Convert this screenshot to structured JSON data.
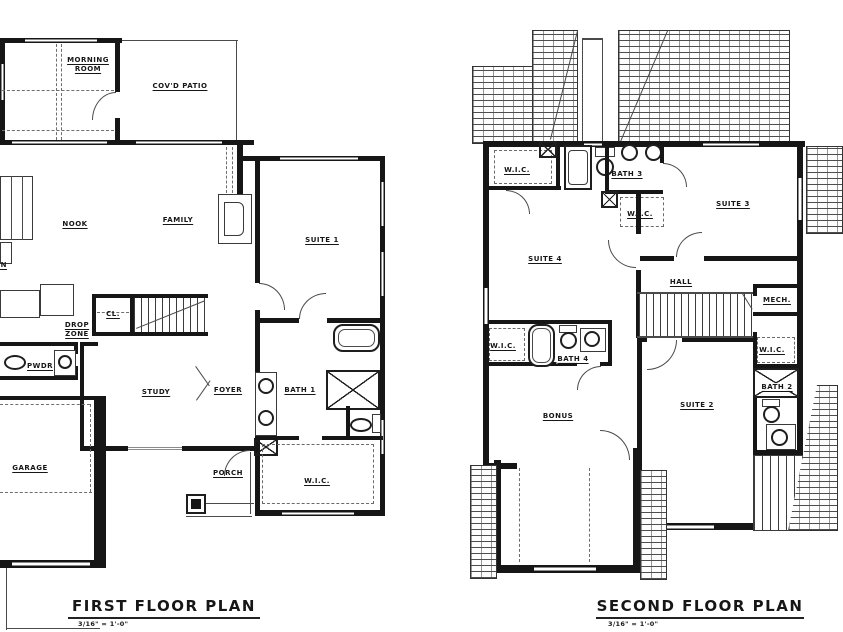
{
  "page": {
    "background": "#ffffff",
    "ink": "#1a1a1a"
  },
  "first_floor": {
    "title": "FIRST FLOOR PLAN",
    "scale": "3/16\" = 1'-0\"",
    "rooms": {
      "morning_room": "MORNING\nROOM",
      "covd_patio": "COV'D PATIO",
      "nook": "NOOK",
      "family": "FAMILY",
      "kitchen": "KITCHEN",
      "suite1": "SUITE 1",
      "drop_zone": "DROP\nZONE",
      "closet": "CL.",
      "pwdr": "PWDR",
      "study": "STUDY",
      "foyer": "FOYER",
      "bath1": "BATH 1",
      "garage": "GARAGE",
      "porch": "PORCH",
      "wic": "W.I.C."
    }
  },
  "second_floor": {
    "title": "SECOND FLOOR PLAN",
    "scale": "3/16\" = 1'-0\"",
    "rooms": {
      "wic_top_left": "W.I.C.",
      "bath3": "BATH 3",
      "wic_mid": "W.I.C.",
      "suite3": "SUITE 3",
      "suite4": "SUITE 4",
      "hall": "HALL",
      "mech": "MECH.",
      "wic_bath4": "W.I.C.",
      "bath4": "BATH 4",
      "bonus": "BONUS",
      "suite2": "SUITE 2",
      "wic_suite2": "W.I.C.",
      "bath2": "BATH 2"
    }
  }
}
